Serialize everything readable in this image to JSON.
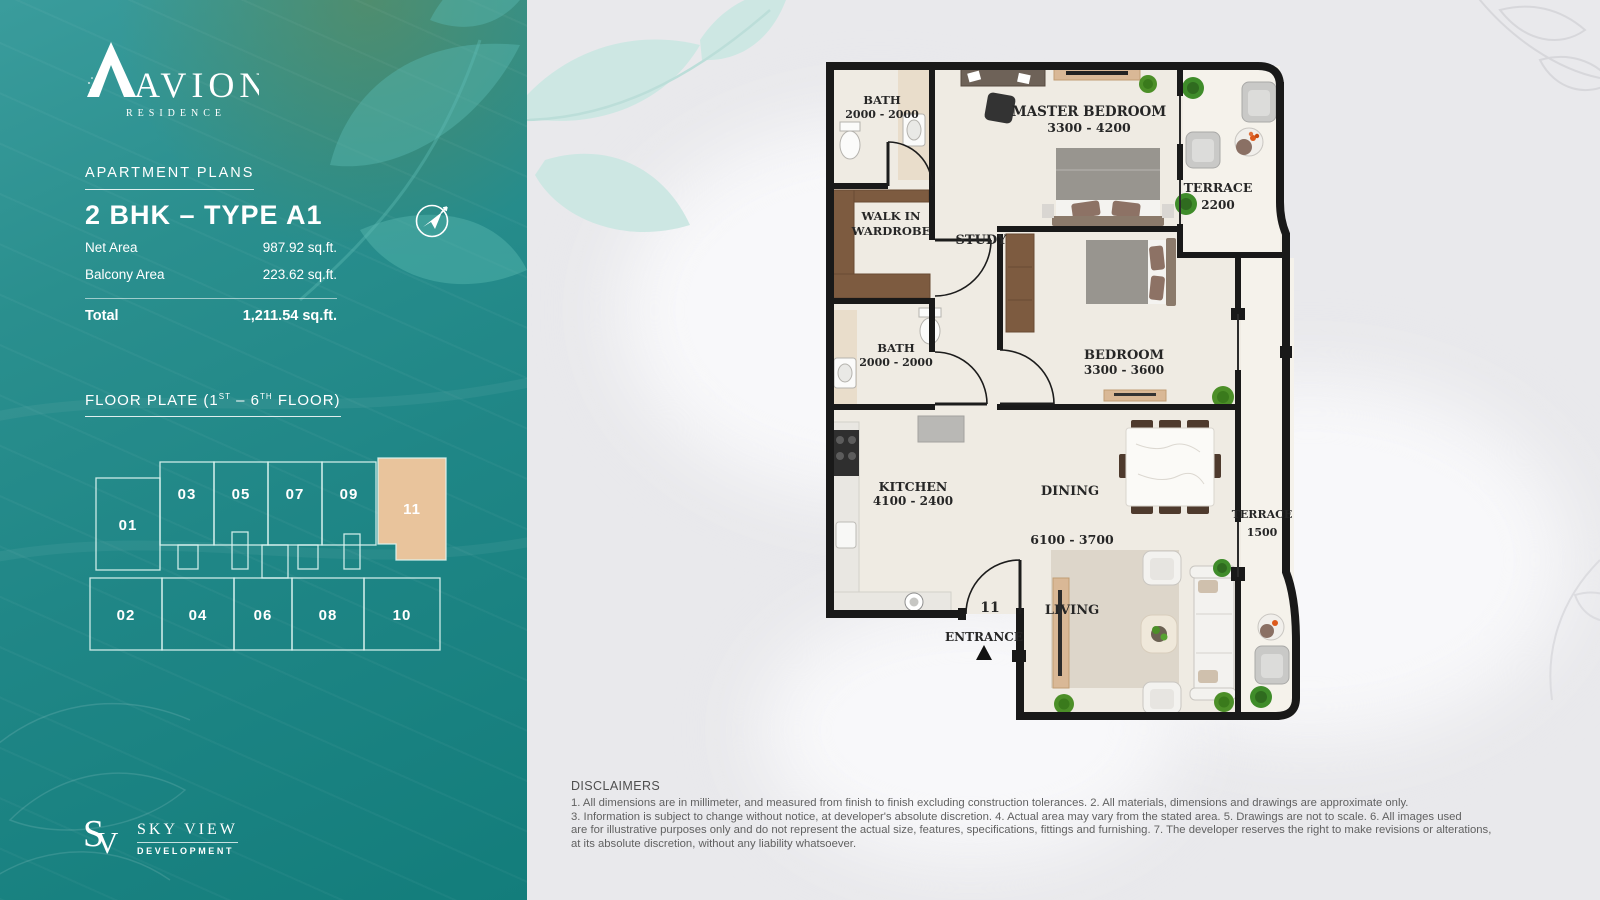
{
  "brand": {
    "name": "AVION",
    "sub": "RESIDENCE"
  },
  "panel": {
    "section_title": "APARTMENT PLANS",
    "unit_title": "2 BHK – TYPE A1",
    "net_area_label": "Net Area",
    "net_area_value": "987.92 sq.ft.",
    "balcony_label": "Balcony Area",
    "balcony_value": "223.62 sq.ft.",
    "total_label": "Total",
    "total_value": "1,211.54 sq.ft.",
    "fp_p1": "FLOOR PLATE (1",
    "fp_s1": "ST",
    "fp_p2": " – 6",
    "fp_s2": "TH",
    "fp_p3": " FLOOR)",
    "plate": {
      "top": [
        "01",
        "03",
        "05",
        "07",
        "09",
        "11"
      ],
      "bottom": [
        "02",
        "04",
        "06",
        "08",
        "10"
      ],
      "highlighted_unit": "11",
      "highlight_color": "#e9c49c"
    }
  },
  "plan": {
    "unit_number": "11",
    "entrance": "ENTRANCE",
    "rooms": {
      "bath1": {
        "name": "BATH",
        "dim": "2000 - 2000"
      },
      "study": {
        "name": "STUDY"
      },
      "master": {
        "name": "MASTER BEDROOM",
        "dim": "3300 - 4200"
      },
      "terrace_top": {
        "name": "TERRACE",
        "dim": "2200"
      },
      "wardrobe": {
        "line1": "WALK IN",
        "line2": "WARDROBE"
      },
      "bath2": {
        "name": "BATH",
        "dim": "2000 - 2000"
      },
      "bedroom": {
        "name": "BEDROOM",
        "dim": "3300 - 3600"
      },
      "kitchen": {
        "name": "KITCHEN",
        "dim": "4100 - 2400"
      },
      "dining": {
        "name": "DINING"
      },
      "living": {
        "name": "LIVING",
        "dim": "6100 - 3700"
      },
      "terrace_right": {
        "name": "TERRACE",
        "dim": "1500"
      }
    }
  },
  "developer": {
    "monogram_s": "S",
    "monogram_v": "V",
    "name": "SKY VIEW",
    "division": "DEVELOPMENT"
  },
  "disclaimers": {
    "title": "DISCLAIMERS",
    "lines": [
      "1. All dimensions are in millimeter, and measured from finish to finish excluding construction tolerances. 2. All materials, dimensions and drawings are approximate only.",
      "3. Information is subject to change without notice, at developer's absolute discretion. 4. Actual area may vary from the stated area. 5. Drawings are not to scale. 6. All images used",
      "are for illustrative purposes only and do not represent the actual size, features, specifications, fittings and furnishing. 7. The developer reserves the right to make revisions or alterations,",
      "at its absolute discretion, without any liability whatsoever."
    ]
  },
  "colors": {
    "teal": "#1f8686",
    "unit_highlight": "#e9c49c",
    "wall": "#191919",
    "wood": "#7d5b40",
    "floor": "#efebe3"
  }
}
